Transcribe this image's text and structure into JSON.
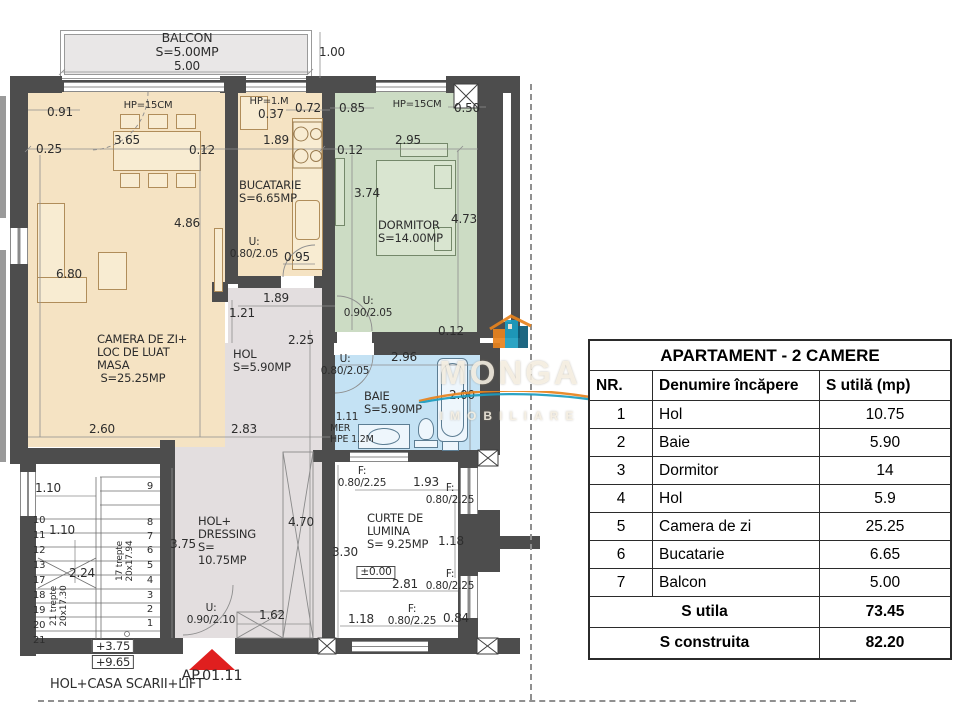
{
  "colors": {
    "wall": "#4d4d4d",
    "living": "#f5e3c3",
    "bedroom": "#ccdcc4",
    "bath": "#c4e2f4",
    "hol": "#e3dedf",
    "balcony": "#e9e7e7",
    "entrance_arrow": "#e01f1f",
    "logo_orange": "#e8831d",
    "logo_teal": "#1b9dc0"
  },
  "logo": {
    "word": "MONGA",
    "sub": "IMOBILIARE"
  },
  "plan": {
    "entrance_label": "AP.01.11",
    "footer_note": "HOL+CASA SCARII+LIFT",
    "labels": [
      {
        "t": "BALCON\nS=5.00MP",
        "x": 187,
        "y": 31,
        "fs": 12.5,
        "n": "label-balcon"
      },
      {
        "t": "5.00",
        "x": 187,
        "y": 60,
        "fs": 12
      },
      {
        "t": "1.00",
        "x": 332,
        "y": 46,
        "fs": 12
      },
      {
        "t": "0.91",
        "x": 60,
        "y": 106,
        "fs": 12
      },
      {
        "t": "HP=15CM",
        "x": 148,
        "y": 100,
        "fs": 10,
        "n": "label-parapet"
      },
      {
        "t": "HP=1.M",
        "x": 269,
        "y": 96,
        "fs": 10,
        "n": "label-parapet"
      },
      {
        "t": "0.37",
        "x": 271,
        "y": 108,
        "fs": 12
      },
      {
        "t": "0.72",
        "x": 308,
        "y": 102,
        "fs": 12
      },
      {
        "t": "0.85",
        "x": 352,
        "y": 102,
        "fs": 12
      },
      {
        "t": "HP=15CM",
        "x": 417,
        "y": 99,
        "fs": 10,
        "n": "label-parapet"
      },
      {
        "t": "0.50",
        "x": 467,
        "y": 102,
        "fs": 12
      },
      {
        "t": "0.25",
        "x": 49,
        "y": 143,
        "fs": 12
      },
      {
        "t": "3.65",
        "x": 127,
        "y": 134,
        "fs": 12
      },
      {
        "t": "0.12",
        "x": 202,
        "y": 144,
        "fs": 12
      },
      {
        "t": "1.89",
        "x": 276,
        "y": 134,
        "fs": 12
      },
      {
        "t": "0.12",
        "x": 350,
        "y": 144,
        "fs": 12
      },
      {
        "t": "2.95",
        "x": 408,
        "y": 134,
        "fs": 12
      },
      {
        "t": "3.74",
        "x": 367,
        "y": 187,
        "fs": 12
      },
      {
        "t": "4.73",
        "x": 464,
        "y": 213,
        "fs": 12
      },
      {
        "t": "4.86",
        "x": 187,
        "y": 217,
        "fs": 12
      },
      {
        "t": "6.80",
        "x": 69,
        "y": 268,
        "fs": 12
      },
      {
        "t": "BUCATARIE\nS=6.65MP",
        "x": 239,
        "y": 179,
        "fs": 11.5,
        "a": 1,
        "n": "label-bucatarie"
      },
      {
        "t": "DORMITOR\nS=14.00MP",
        "x": 378,
        "y": 219,
        "fs": 11.5,
        "a": 1,
        "n": "label-dormitor"
      },
      {
        "t": "U:\n0.80/2.05",
        "x": 254,
        "y": 237,
        "fs": 10.5,
        "n": "label-door"
      },
      {
        "t": "0.95",
        "x": 297,
        "y": 251,
        "fs": 12
      },
      {
        "t": "1.89",
        "x": 276,
        "y": 292,
        "fs": 12
      },
      {
        "t": "1.21",
        "x": 242,
        "y": 307,
        "fs": 12
      },
      {
        "t": "2.25",
        "x": 301,
        "y": 334,
        "fs": 12
      },
      {
        "t": "U:\n0.90/2.05",
        "x": 368,
        "y": 296,
        "fs": 10.5,
        "n": "label-door"
      },
      {
        "t": "0.12",
        "x": 451,
        "y": 325,
        "fs": 12
      },
      {
        "t": "CAMERA DE ZI+\nLOC DE LUAT\nMASA\n S=25.25MP",
        "x": 97,
        "y": 333,
        "fs": 11.5,
        "a": 1,
        "n": "label-camera-de-zi"
      },
      {
        "t": "HOL\nS=5.90MP",
        "x": 233,
        "y": 348,
        "fs": 11.5,
        "a": 1,
        "n": "label-hol"
      },
      {
        "t": "2.96",
        "x": 404,
        "y": 351,
        "fs": 12
      },
      {
        "t": "U:\n0.80/2.05",
        "x": 345,
        "y": 354,
        "fs": 10.5,
        "n": "label-door"
      },
      {
        "t": "BAIE\nS=5.90MP",
        "x": 364,
        "y": 390,
        "fs": 11.5,
        "a": 1,
        "n": "label-baie"
      },
      {
        "t": "2.00",
        "x": 462,
        "y": 389,
        "fs": 12
      },
      {
        "t": "1.11",
        "x": 347,
        "y": 412,
        "fs": 10.5
      },
      {
        "t": "MER\nHPE 1.2M",
        "x": 330,
        "y": 424,
        "fs": 9.5,
        "a": 1
      },
      {
        "t": "2.60",
        "x": 102,
        "y": 423,
        "fs": 12
      },
      {
        "t": "2.83",
        "x": 244,
        "y": 423,
        "fs": 12
      },
      {
        "t": "1.10",
        "x": 48,
        "y": 482,
        "fs": 12
      },
      {
        "t": "1.10",
        "x": 62,
        "y": 524,
        "fs": 12
      },
      {
        "t": "2.24",
        "x": 82,
        "y": 567,
        "fs": 12
      },
      {
        "t": "3.75",
        "x": 183,
        "y": 538,
        "fs": 12
      },
      {
        "t": "17 trepte\n20x17.94",
        "x": 125,
        "y": 561,
        "fs": 9,
        "r": 1,
        "n": "label-stairs-flight"
      },
      {
        "t": "21 trepte\n20x17.30",
        "x": 59,
        "y": 606,
        "fs": 9,
        "r": 1,
        "n": "label-stairs-flight"
      },
      {
        "t": "+3.75",
        "x": 113,
        "y": 639,
        "fs": 11.5,
        "b": 1,
        "n": "label-level"
      },
      {
        "t": "+9.65",
        "x": 113,
        "y": 655,
        "fs": 11.5,
        "b": 1,
        "n": "label-level"
      },
      {
        "t": "HOL+\nDRESSING\nS=\n10.75MP",
        "x": 198,
        "y": 515,
        "fs": 11.5,
        "a": 1,
        "n": "label-hol-dressing"
      },
      {
        "t": "4.70",
        "x": 301,
        "y": 516,
        "fs": 12
      },
      {
        "t": "U:\n0.90/2.10",
        "x": 211,
        "y": 603,
        "fs": 10.5,
        "n": "label-door"
      },
      {
        "t": "1.62",
        "x": 272,
        "y": 609,
        "fs": 12
      },
      {
        "t": "CURTE DE\nLUMINA\nS= 9.25MP",
        "x": 367,
        "y": 512,
        "fs": 11.5,
        "a": 1,
        "n": "label-curte-de-lumina"
      },
      {
        "t": "3.30",
        "x": 345,
        "y": 546,
        "fs": 12
      },
      {
        "t": "±0.00",
        "x": 376,
        "y": 566,
        "fs": 10.5,
        "b": 1,
        "n": "label-level"
      },
      {
        "t": "1.93",
        "x": 426,
        "y": 476,
        "fs": 12
      },
      {
        "t": "F:\n0.80/2.25",
        "x": 362,
        "y": 466,
        "fs": 10.5,
        "n": "label-window"
      },
      {
        "t": "F:\n0.80/2.25",
        "x": 450,
        "y": 483,
        "fs": 10.5,
        "n": "label-window"
      },
      {
        "t": "1.18",
        "x": 451,
        "y": 535,
        "fs": 12
      },
      {
        "t": "2.81",
        "x": 405,
        "y": 578,
        "fs": 12
      },
      {
        "t": "F:\n0.80/2.25",
        "x": 450,
        "y": 569,
        "fs": 10.5,
        "n": "label-window"
      },
      {
        "t": "1.18",
        "x": 361,
        "y": 613,
        "fs": 12
      },
      {
        "t": "F:\n0.80/2.25",
        "x": 412,
        "y": 604,
        "fs": 10.5,
        "n": "label-window"
      },
      {
        "t": "0.84",
        "x": 456,
        "y": 612,
        "fs": 12
      },
      {
        "t": "9",
        "x": 150,
        "y": 481,
        "fs": 10
      },
      {
        "t": "8",
        "x": 150,
        "y": 517,
        "fs": 10
      },
      {
        "t": "7",
        "x": 150,
        "y": 531,
        "fs": 10
      },
      {
        "t": "6",
        "x": 150,
        "y": 545,
        "fs": 10
      },
      {
        "t": "5",
        "x": 150,
        "y": 560,
        "fs": 10
      },
      {
        "t": "4",
        "x": 150,
        "y": 575,
        "fs": 10
      },
      {
        "t": "3",
        "x": 150,
        "y": 590,
        "fs": 10
      },
      {
        "t": "2",
        "x": 150,
        "y": 604,
        "fs": 10
      },
      {
        "t": "1",
        "x": 150,
        "y": 618,
        "fs": 10
      },
      {
        "t": "10",
        "x": 33,
        "y": 515,
        "fs": 10,
        "a": 1
      },
      {
        "t": "11",
        "x": 33,
        "y": 530,
        "fs": 10,
        "a": 1
      },
      {
        "t": "12",
        "x": 33,
        "y": 545,
        "fs": 10,
        "a": 1
      },
      {
        "t": "13",
        "x": 33,
        "y": 560,
        "fs": 10,
        "a": 1
      },
      {
        "t": "17",
        "x": 33,
        "y": 575,
        "fs": 10,
        "a": 1
      },
      {
        "t": "18",
        "x": 33,
        "y": 590,
        "fs": 10,
        "a": 1
      },
      {
        "t": "19",
        "x": 33,
        "y": 605,
        "fs": 10,
        "a": 1
      },
      {
        "t": "20",
        "x": 33,
        "y": 620,
        "fs": 10,
        "a": 1
      },
      {
        "t": "21",
        "x": 33,
        "y": 635,
        "fs": 10,
        "a": 1
      }
    ]
  },
  "table": {
    "title": "APARTAMENT - 2 CAMERE",
    "headers": [
      "NR.",
      "Denumire încăpere",
      "S utilă (mp)"
    ],
    "rows": [
      [
        "1",
        "Hol",
        "10.75"
      ],
      [
        "2",
        "Baie",
        "5.90"
      ],
      [
        "3",
        "Dormitor",
        "14"
      ],
      [
        "4",
        "Hol",
        "5.9"
      ],
      [
        "5",
        "Camera de zi",
        "25.25"
      ],
      [
        "6",
        "Bucatarie",
        "6.65"
      ],
      [
        "7",
        "Balcon",
        "5.00"
      ]
    ],
    "totals": [
      [
        "S utila",
        "73.45"
      ],
      [
        "S construita",
        "82.20"
      ]
    ]
  }
}
